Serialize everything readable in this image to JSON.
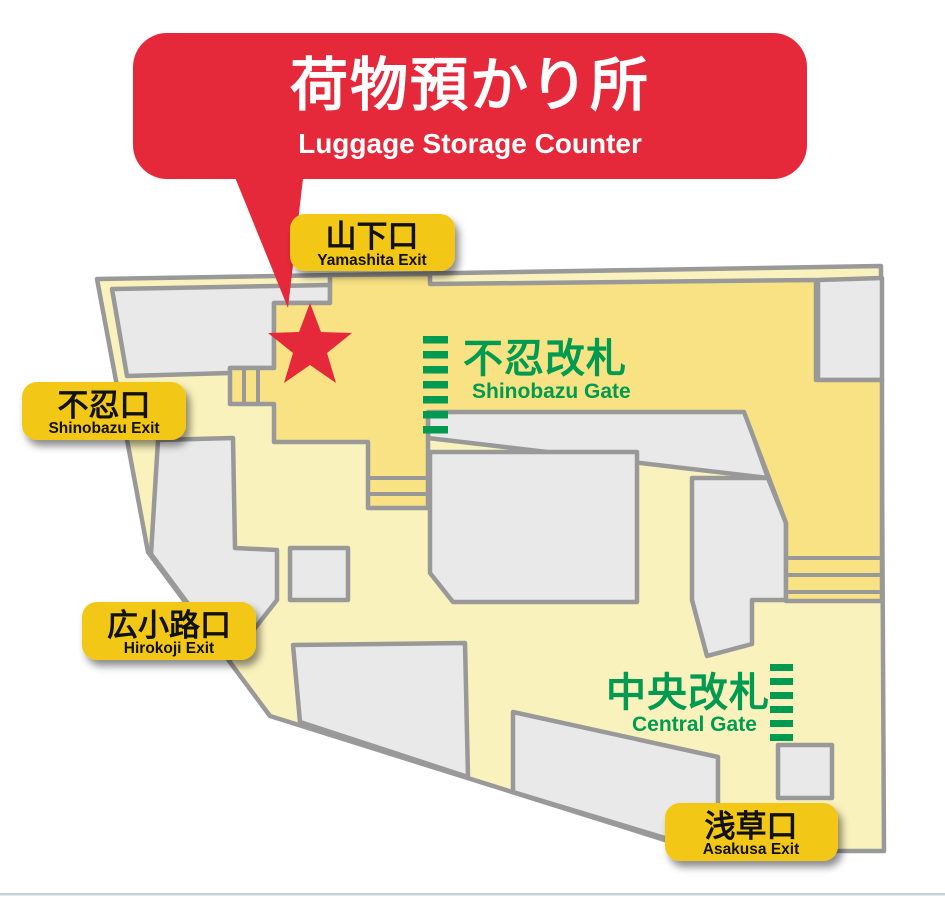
{
  "callout": {
    "jp": "荷物預かり所",
    "en": "Luggage Storage Counter"
  },
  "exits": {
    "yamashita": {
      "jp": "山下口",
      "en": "Yamashita Exit"
    },
    "shinobazu": {
      "jp": "不忍口",
      "en": "Shinobazu Exit"
    },
    "hirokoji": {
      "jp": "広小路口",
      "en": "Hirokoji Exit"
    },
    "asakusa": {
      "jp": "浅草口",
      "en": "Asakusa Exit"
    }
  },
  "gates": {
    "shinobazu": {
      "jp": "不忍改札",
      "en": "Shinobazu Gate"
    },
    "central": {
      "jp": "中央改札",
      "en": "Central Gate"
    }
  },
  "marker": {
    "meaning": "luggage storage counter location"
  },
  "colors": {
    "callout_red": "#E5293A",
    "exit_label_yellow": "#F3C713",
    "gate_area_yellow": "#F8E284",
    "concourse_cream": "#FAF2BD",
    "block_gray": "#E9E9E9",
    "outline_gray": "#999999",
    "gate_green": "#009A50"
  }
}
